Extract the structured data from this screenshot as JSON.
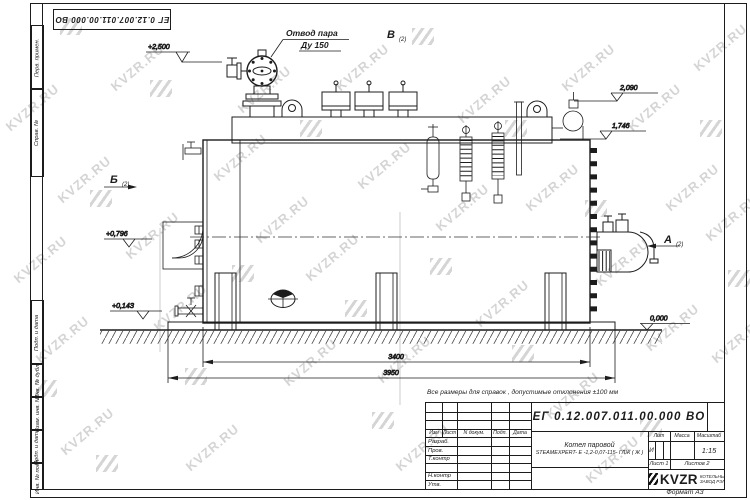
{
  "sheet": {
    "doc_number": "ЕГ 0.12.007.011.00.000 ВО",
    "format_label": "Формат А3",
    "reference_note": "Все размеры для справок , допустимые отклонения ±100 мм"
  },
  "margin_columns": {
    "labels": [
      "Перв. примен.",
      "Справ. №",
      "Подп. и дата",
      "Инв. № дубл.",
      "Взам. инв. №",
      "Подп. и дата",
      "Инв. № подл."
    ]
  },
  "title_block": {
    "doc_number": "ЕГ 0.12.007.011.00.000  ВО",
    "col_headers": {
      "izm": "Изм",
      "list": "Лист",
      "ndokum": "N докум.",
      "podp": "Подп.",
      "data": "Дата"
    },
    "row_labels": {
      "razrab": "Разраб.",
      "prov": "Пров.",
      "tkontr": "Т.контр",
      "nkontr": "Н.контр",
      "utv": "Утв."
    },
    "product_line1": "Котел паровой",
    "product_line2": "STEAMEXPERT- Е -1,2-0,07-115- ГЛЖ ( Ж )",
    "lit_header": "Лит",
    "mass_header": "Масса",
    "scale_header": "Масштаб",
    "lit_value": "И",
    "scale_value": "1:15",
    "sheet_info": "Лист  1",
    "sheets_info": "Листов  2",
    "logo_text": "KVZR",
    "logo_caption1": "КОТЕЛЬНЫЙ",
    "logo_caption2": "ЗАВОД РЭП"
  },
  "drawing": {
    "callout_line1": "Отвод пара",
    "callout_line2": "Ду 150",
    "view_b": "Б",
    "view_v": "В",
    "view_a": "А",
    "view_index": "(2)",
    "elevations": {
      "e2500": "+2,500",
      "e2090": "2,090",
      "e1746": "1,746",
      "e0796": "+0,796",
      "e0143": "+0,14З",
      "e0000": "0,000"
    },
    "dim_3400": "3400",
    "dim_3950": "3950"
  },
  "watermark": {
    "text": "KVZR.RU",
    "color": "#7d7d7d"
  }
}
